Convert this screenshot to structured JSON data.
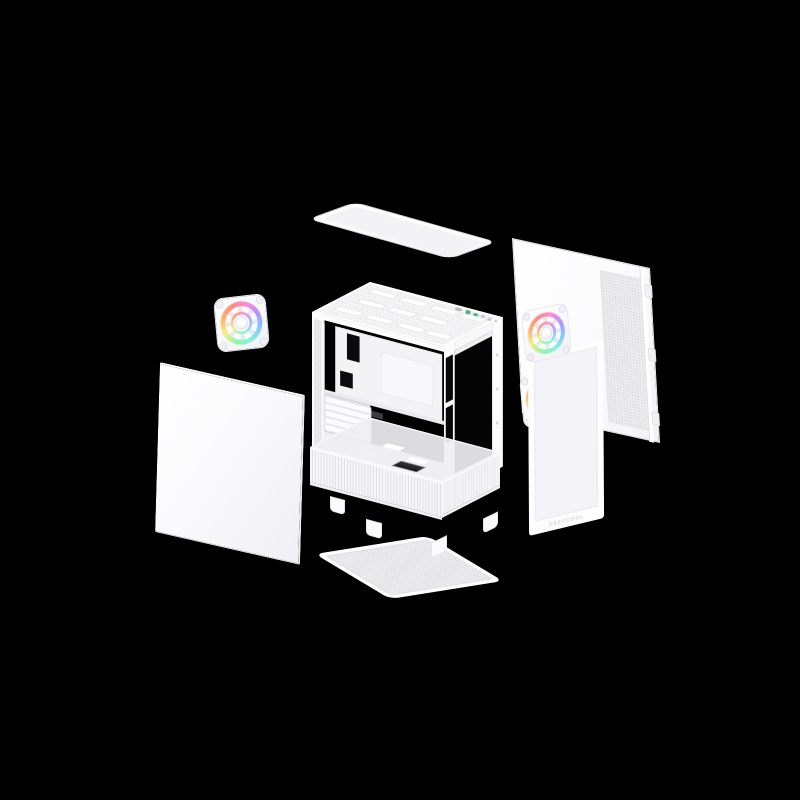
{
  "scene": {
    "background_color": "#000000",
    "product": {
      "glass_logo_text": "DEEPCOOL"
    },
    "colors": {
      "shell": "#fbfbfd",
      "frame_border": "#e8e8ed",
      "mesh_fill": "#ececef",
      "mesh_dot": "#d6d6dc",
      "glass_tint": "#f3f3f8",
      "sticker_dark": "#35353b",
      "io_green": "#55b271",
      "io_teal": "#58b98c",
      "logo_text": "#c5c5cc"
    },
    "fan_ring_colors": [
      "#8df7a9",
      "#f7f17a",
      "#ffb36e",
      "#ff8a80",
      "#ff8ad6",
      "#b892ff",
      "#7fc9ff",
      "#86f2dd"
    ],
    "parts": [
      {
        "name": "top-dust-filter"
      },
      {
        "name": "rear-side-panel"
      },
      {
        "name": "rear-exhaust-rgb-fan"
      },
      {
        "name": "left-side-panel"
      },
      {
        "name": "main-chassis"
      },
      {
        "name": "front-rgb-fan-upper"
      },
      {
        "name": "front-rgb-fan-lower"
      },
      {
        "name": "front-glass-panel"
      },
      {
        "name": "bottom-dust-filter"
      }
    ]
  }
}
